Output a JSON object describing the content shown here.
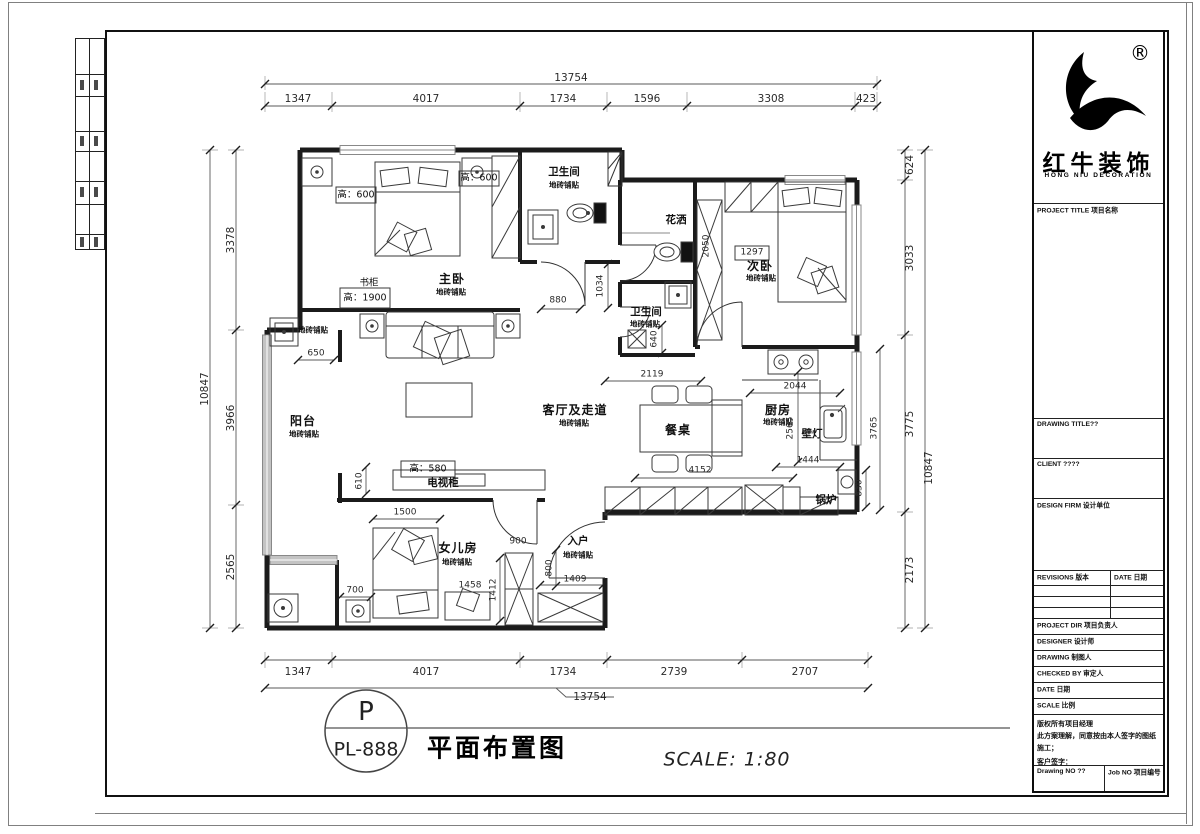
{
  "sheet": {
    "logo": {
      "registered": "®",
      "brand": "红牛装饰",
      "brand_en": "HONG NIU DECORATION"
    },
    "titleblock": {
      "project_title": "PROJECT TITLE  项目名称",
      "drawing_title": "DRAWING TITLE??",
      "client": "CLIENT ????",
      "design_firm": "DESIGN FIRM 设计单位",
      "revisions": "REVISIONS 版本",
      "date_col": "DATE 日期",
      "project_dir": "PROJECT DIR  项目负责人",
      "designer": "DESIGNER  设计师",
      "drawing": "DRAWING  制图人",
      "checked_by": "CHECKED BY  审定人",
      "date": "DATE  日期",
      "scale": "SCALE  比例",
      "note_line1": "版权所有项目经理",
      "note_line2": "此方案理解，同意按由本人签字的图纸施工；",
      "note_line3": "客户签字：",
      "drawing_no": "Drawing NO ??",
      "job_no": "Job NO 项目编号"
    },
    "footer": {
      "tag_letter": "P",
      "tag_code": "PL-888",
      "drawing_name": "平面布置图",
      "scale_text": "SCALE: 1:80"
    }
  },
  "plan": {
    "rooms": {
      "master": "主卧",
      "bath1": "卫生间",
      "bath2": "卫生间",
      "shower": "花洒",
      "second": "次卧",
      "balcony": "阳台",
      "living": "客厅及走道",
      "dining": "餐桌",
      "kitchen": "厨房",
      "daughter": "女儿房",
      "entry": "入户",
      "boiler": "锅炉",
      "tv": "电视柜",
      "bookcase": "书柜",
      "lamp": "壁灯",
      "tile": "地砖铺贴"
    },
    "heights": {
      "h600": "高：600",
      "h1900": "高：1900",
      "h580": "高：580"
    },
    "dims": {
      "top_all": "13754",
      "top": [
        "1347",
        "4017",
        "1734",
        "1596",
        "3308",
        "423"
      ],
      "bottom": [
        "1347",
        "4017",
        "1734",
        "2739",
        "2707"
      ],
      "bottom_all": "13754",
      "left": [
        "3378",
        "3966",
        "2565"
      ],
      "left_all": "10847",
      "right": [
        "624",
        "3033",
        "3775",
        "2173"
      ],
      "right_all": "10847",
      "inner": {
        "d880": "880",
        "d1034": "1034",
        "d650": "650",
        "d2050": "2050",
        "d1297": "1297",
        "d640": "640",
        "d2119": "2119",
        "d2044": "2044",
        "d2565": "2565",
        "d1444": "1444",
        "d830": "830",
        "d3765": "3765",
        "d4152": "4152",
        "d610": "610",
        "d1500": "1500",
        "d900": "900",
        "d700": "700",
        "d1458": "1458",
        "d1412": "1412",
        "d800": "800",
        "d1409": "1409"
      }
    }
  }
}
